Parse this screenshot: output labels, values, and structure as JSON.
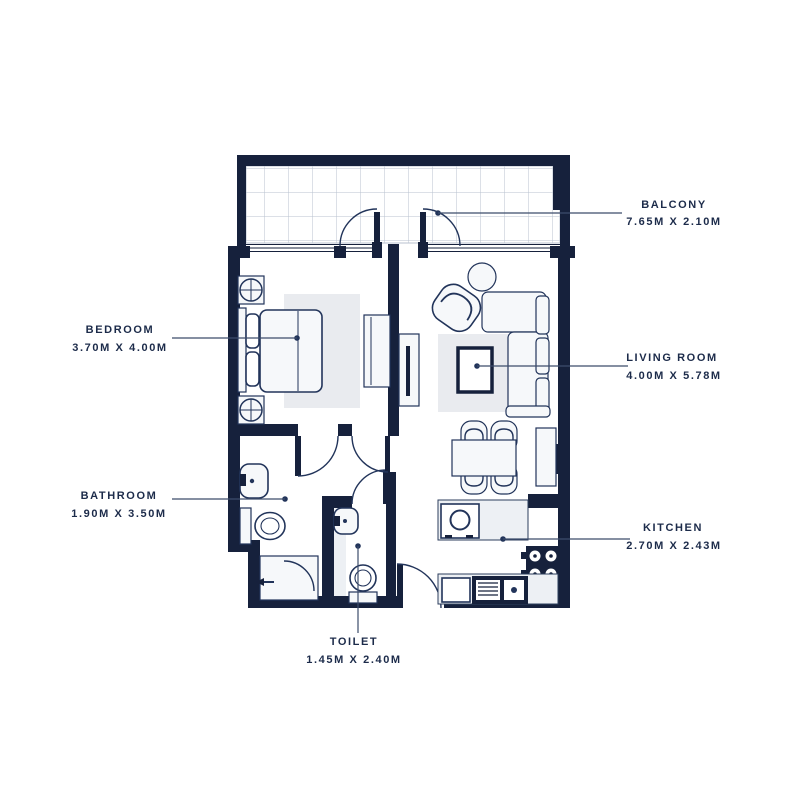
{
  "palette": {
    "wall": "#16213c",
    "furniture_outline": "#22345a",
    "furniture_fill": "#f6f8fa",
    "rug": "#e9ebef",
    "tile_grid": "#b9c2cf",
    "leader_line": "#3c4c6b",
    "text": "#1c2b4a",
    "background": "#ffffff"
  },
  "rooms": {
    "balcony": {
      "name": "BALCONY",
      "size": "7.65M X 2.10M"
    },
    "bedroom": {
      "name": "BEDROOM",
      "size": "3.70M X 4.00M"
    },
    "living_room": {
      "name": "LIVING ROOM",
      "size": "4.00M X 5.78M"
    },
    "bathroom": {
      "name": "BATHROOM",
      "size": "1.90M X 3.50M"
    },
    "kitchen": {
      "name": "KITCHEN",
      "size": "2.70M X 2.43M"
    },
    "toilet": {
      "name": "TOILET",
      "size": "1.45M X 2.40M"
    }
  }
}
